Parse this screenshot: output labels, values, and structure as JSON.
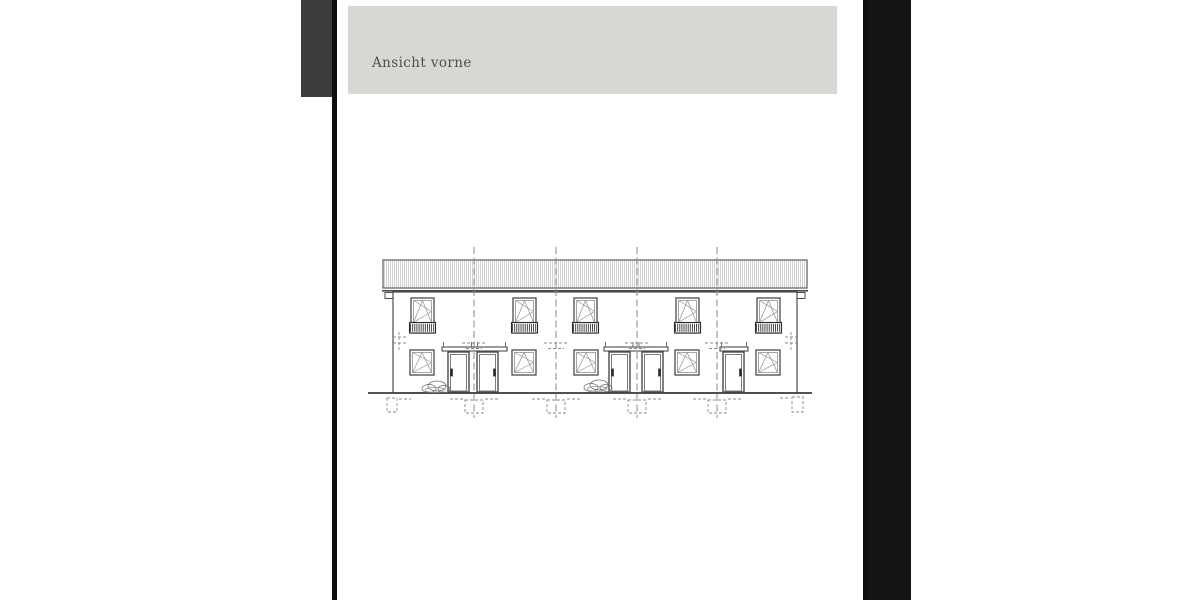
{
  "window": {
    "outer_background": "#ffffff",
    "page_background": "#ffffff",
    "border_color": "#0e0e0e",
    "left_edge_artifact_color": "#3c3c3e",
    "right_edge_artifact_color": "#141416"
  },
  "document": {
    "header": {
      "title": "Ansicht vorne",
      "background": "#d8d7d3",
      "text_color": "#50504c"
    }
  },
  "drawing": {
    "colors": {
      "main": "#4b4b4b",
      "mid": "#6e6e6e",
      "light": "#8f8f8f",
      "dash": "#8a8a8a",
      "rail": "#2a2a2a",
      "hatch": "#b2b2b2",
      "dark": "#3c3c3c",
      "fill": "#ffffff"
    },
    "roof": {
      "x": 383,
      "y": 260,
      "w": 424,
      "h": 28,
      "fascia_y": 290.8,
      "hatch_step": 2
    },
    "gutter_caps": [
      {
        "x": 385,
        "y": 292.5,
        "w": 9,
        "h": 6
      },
      {
        "x": 796,
        "y": 292.5,
        "w": 9,
        "h": 6
      }
    ],
    "wall": {
      "x": 393,
      "y": 292,
      "w": 404,
      "h": 101
    },
    "ground": {
      "x1": 368,
      "x2": 812,
      "y": 393
    },
    "party_wall_lines": {
      "xs": [
        474,
        556,
        637,
        717
      ],
      "y_top": 247,
      "y_bottom": 418,
      "cross_y1": 343,
      "cross_y2": 348.5
    },
    "upper_windows": {
      "xs": [
        411,
        513,
        574,
        676,
        757
      ],
      "y": 298,
      "w": 23,
      "h": 35,
      "railing_top": 322.5,
      "railing_h": 10.5
    },
    "lower_windows": {
      "xs": [
        410,
        512,
        574,
        675,
        756
      ],
      "y": 350,
      "w": 24,
      "h": 25
    },
    "doors": {
      "y": 352,
      "w": 21,
      "h": 40,
      "items": [
        {
          "x": 448,
          "handle": "left"
        },
        {
          "x": 477,
          "handle": "right"
        },
        {
          "x": 609,
          "handle": "left"
        },
        {
          "x": 642,
          "handle": "right"
        },
        {
          "x": 723,
          "handle": "right"
        }
      ]
    },
    "canopies": [
      {
        "x": 442,
        "w": 65
      },
      {
        "x": 604,
        "w": 64
      },
      {
        "x": 720,
        "w": 28
      }
    ],
    "shrubs": [
      {
        "cx": 437,
        "cy": 387
      },
      {
        "cx": 599,
        "cy": 386
      }
    ],
    "edge_level_markers": [
      {
        "x": 399,
        "hx1": 393,
        "hx2": 406
      },
      {
        "x": 791,
        "hx1": 785,
        "hx2": 799
      }
    ],
    "edge_foundations": [
      {
        "x": 387,
        "y": 398,
        "w": 10,
        "h": 14,
        "dx1": 399,
        "dx2": 411
      },
      {
        "x": 792,
        "y": 397,
        "w": 11,
        "h": 15,
        "dx1": 780,
        "dx2": 790
      }
    ],
    "party_foundations": {
      "half_w": 9,
      "y": 400,
      "h": 13,
      "side_reach": 24
    }
  },
  "layout": {
    "page_left": 337,
    "page_width": 526,
    "border_left_x": 332,
    "border_right_x": 863,
    "border_w": 5,
    "left_artifact": {
      "x": 301,
      "y": 0,
      "w": 31,
      "h": 97
    },
    "right_artifact": {
      "x": 868,
      "y": 0,
      "w": 43,
      "h": 600
    },
    "header": {
      "x": 348,
      "y": 6,
      "w": 489,
      "h": 88,
      "text_left": 24,
      "text_top": 50
    }
  }
}
